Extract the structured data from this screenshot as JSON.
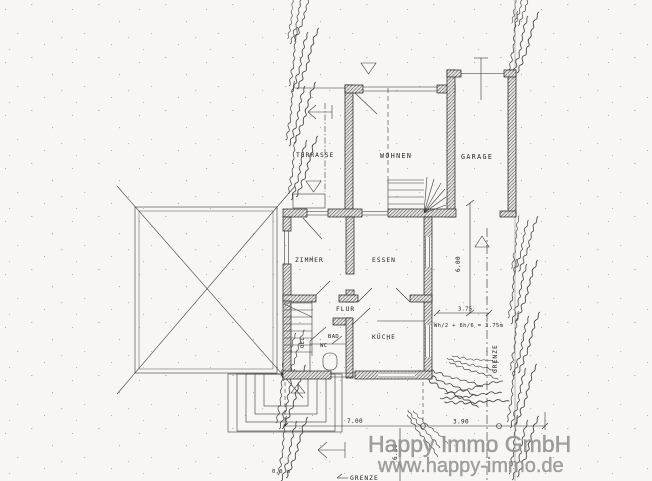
{
  "rooms": {
    "terrasse": "TERRASSE",
    "wohnen": "WOHNEN",
    "garage": "GARAGE",
    "zimmer": "ZIMMER",
    "essen": "ESSEN",
    "flur": "FLUR",
    "bad": "BAD",
    "wc": "WC",
    "kueche": "KÜCHE",
    "oel": "OEL"
  },
  "dimensions": {
    "right_height": "6.00",
    "right_width": "3.75",
    "setback_formula": "Wh/2 + 6h/6 = 3.75m",
    "bottom_width_left": "7.00",
    "bottom_width_right": "3.90",
    "bottom_height": "6.50",
    "level_mark": "0,0 m"
  },
  "boundary": {
    "right_label": "GRENZE",
    "bottom_label": "GRENZE"
  },
  "watermark": {
    "line1": "Happy Immo GmbH",
    "line2": "www.happy-immo.de"
  },
  "colors": {
    "paper": "#f7f6f3",
    "ink": "#2b2b2b",
    "watermark": "#979797"
  }
}
